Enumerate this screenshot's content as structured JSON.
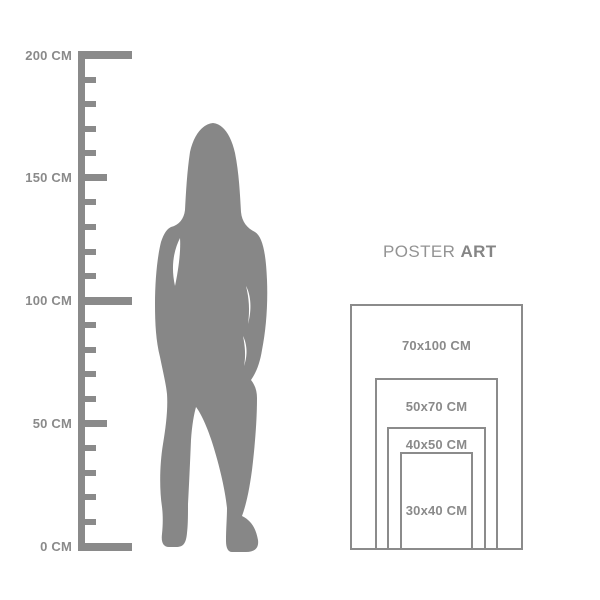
{
  "colors": {
    "silhouette": "#878787",
    "ruler": "#8a8a8a",
    "rect_border": "#8b8b8b",
    "label_text": "#8a8a8a",
    "title_poster": "#939393",
    "title_art": "#858585",
    "background": "#ffffff"
  },
  "title": {
    "poster": "POSTER",
    "art": "ART"
  },
  "ruler": {
    "unit": "CM",
    "min_cm": 0,
    "max_cm": 200,
    "tick_step_cm": 10,
    "medium_tick_every_cm": 50,
    "major_tick_every_cm": 100,
    "labels": [
      {
        "cm": 200,
        "text": "200 CM"
      },
      {
        "cm": 150,
        "text": "150 CM"
      },
      {
        "cm": 100,
        "text": "100 CM"
      },
      {
        "cm": 50,
        "text": "50 CM"
      },
      {
        "cm": 0,
        "text": "0 CM"
      }
    ]
  },
  "figure": {
    "name": "standing woman silhouette"
  },
  "poster_sizes": [
    {
      "label": "70x100 CM",
      "width_cm": 70,
      "height_cm": 100
    },
    {
      "label": "50x70 CM",
      "width_cm": 50,
      "height_cm": 70
    },
    {
      "label": "40x50 CM",
      "width_cm": 40,
      "height_cm": 50
    },
    {
      "label": "30x40 CM",
      "width_cm": 30,
      "height_cm": 40
    }
  ]
}
